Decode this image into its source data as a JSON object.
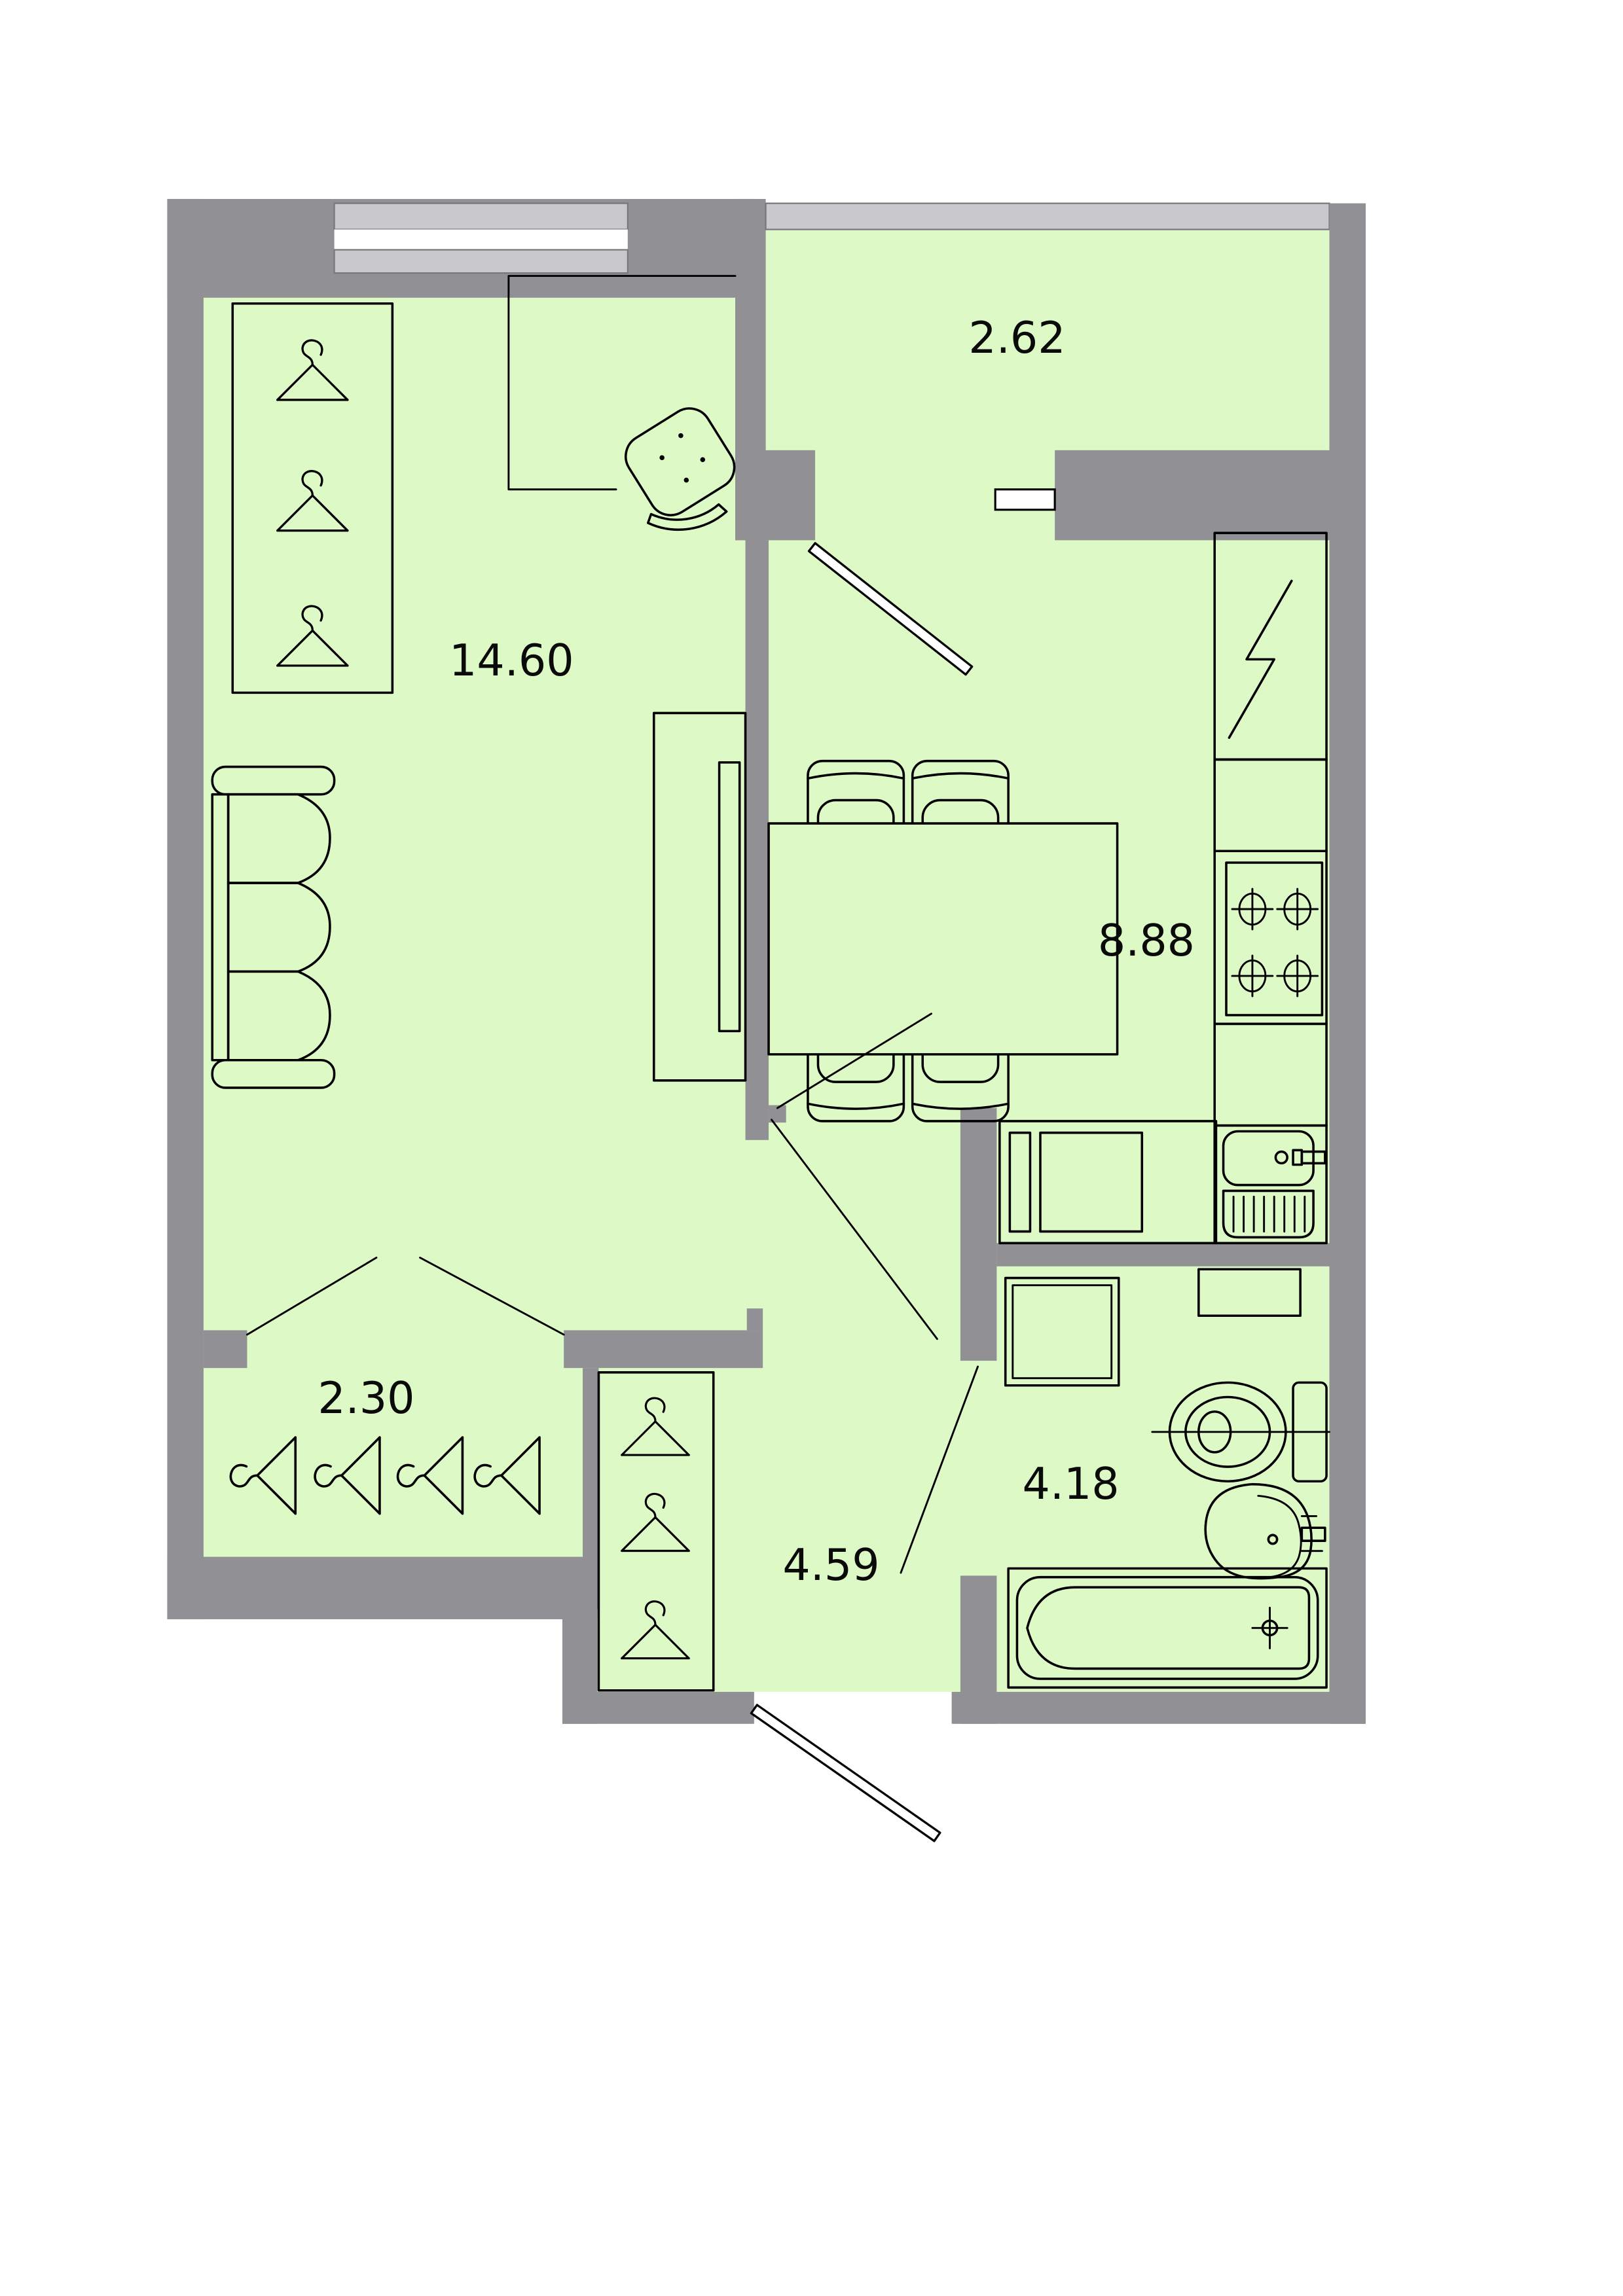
{
  "document": {
    "type": "apartment-floor-plan",
    "description": "Top-view architectural floor plan of a one-bedroom apartment with green room fills and gray walls"
  },
  "colors": {
    "room_fill": "#ddfac6",
    "wall": "#909095",
    "glazing": "#c9c9cd",
    "glazing_edge": "#77777c",
    "line": "#000000",
    "background": "#ffffff"
  },
  "rooms": [
    {
      "name": "living-room",
      "area_label": "14.60"
    },
    {
      "name": "balcony",
      "area_label": "2.62"
    },
    {
      "name": "kitchen-dining",
      "area_label": "8.88"
    },
    {
      "name": "closet",
      "area_label": "2.30"
    },
    {
      "name": "hallway",
      "area_label": "4.59"
    },
    {
      "name": "bathroom",
      "area_label": "4.18"
    }
  ],
  "fixtures": [
    "wardrobe-with-hangers",
    "sofa",
    "desk",
    "office-chair",
    "dining-table",
    "dining-chairs",
    "tv-cabinet",
    "tv",
    "refrigerator-electric-symbol",
    "stove-4-burner",
    "kitchen-sink-with-drainer",
    "counter-with-washing-machine",
    "washing-machine",
    "shelf",
    "toilet",
    "wash-basin",
    "bathtub",
    "coat-hangers-closet",
    "hallway-wardrobe-hangers",
    "entrance-door",
    "balcony-door",
    "bathroom-door",
    "double-door-closet",
    "window"
  ]
}
